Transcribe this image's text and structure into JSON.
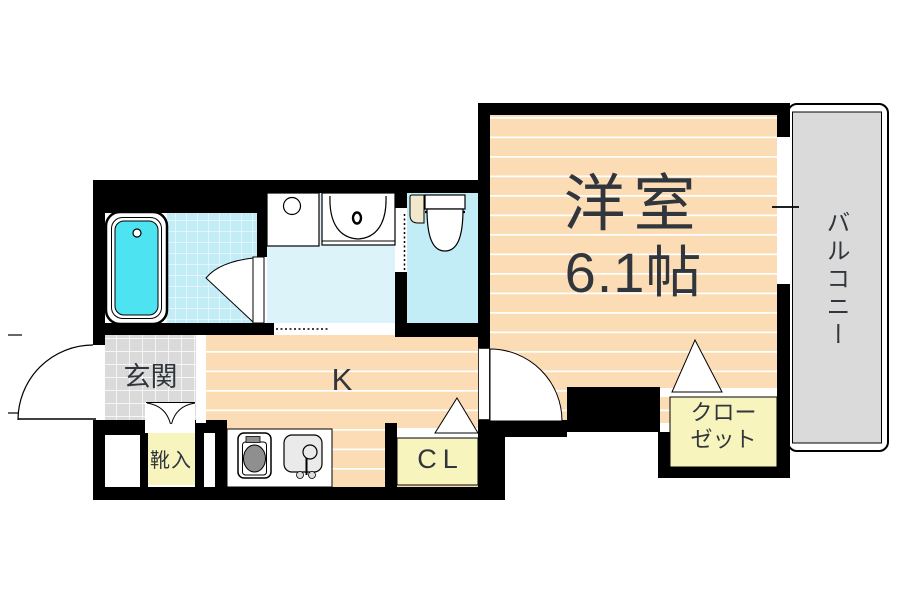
{
  "title": "1K apartment floor plan",
  "rooms": {
    "western_room": {
      "label": "洋室",
      "size_label": "6.1帖"
    },
    "balcony": {
      "label": "バルコニー"
    },
    "kitchen": {
      "label": "K"
    },
    "entrance": {
      "label": "玄関"
    },
    "shoe_box": {
      "label": "靴入"
    },
    "closet_cl": {
      "label": "CL"
    },
    "closet": {
      "label": "クロー\nゼット"
    }
  },
  "colors": {
    "wall": "#000000",
    "flooring": "#FBDCB4",
    "storage": "#F7F4BE",
    "gray": "#DADADA",
    "tile": "#C2EDF6",
    "washroom": "#DCF3F9",
    "tub": "#4DE3F0",
    "burner": "#8F8F8F",
    "sink": "#EAEAEA",
    "cream": "#F2E9CD",
    "text": "#31363C"
  }
}
